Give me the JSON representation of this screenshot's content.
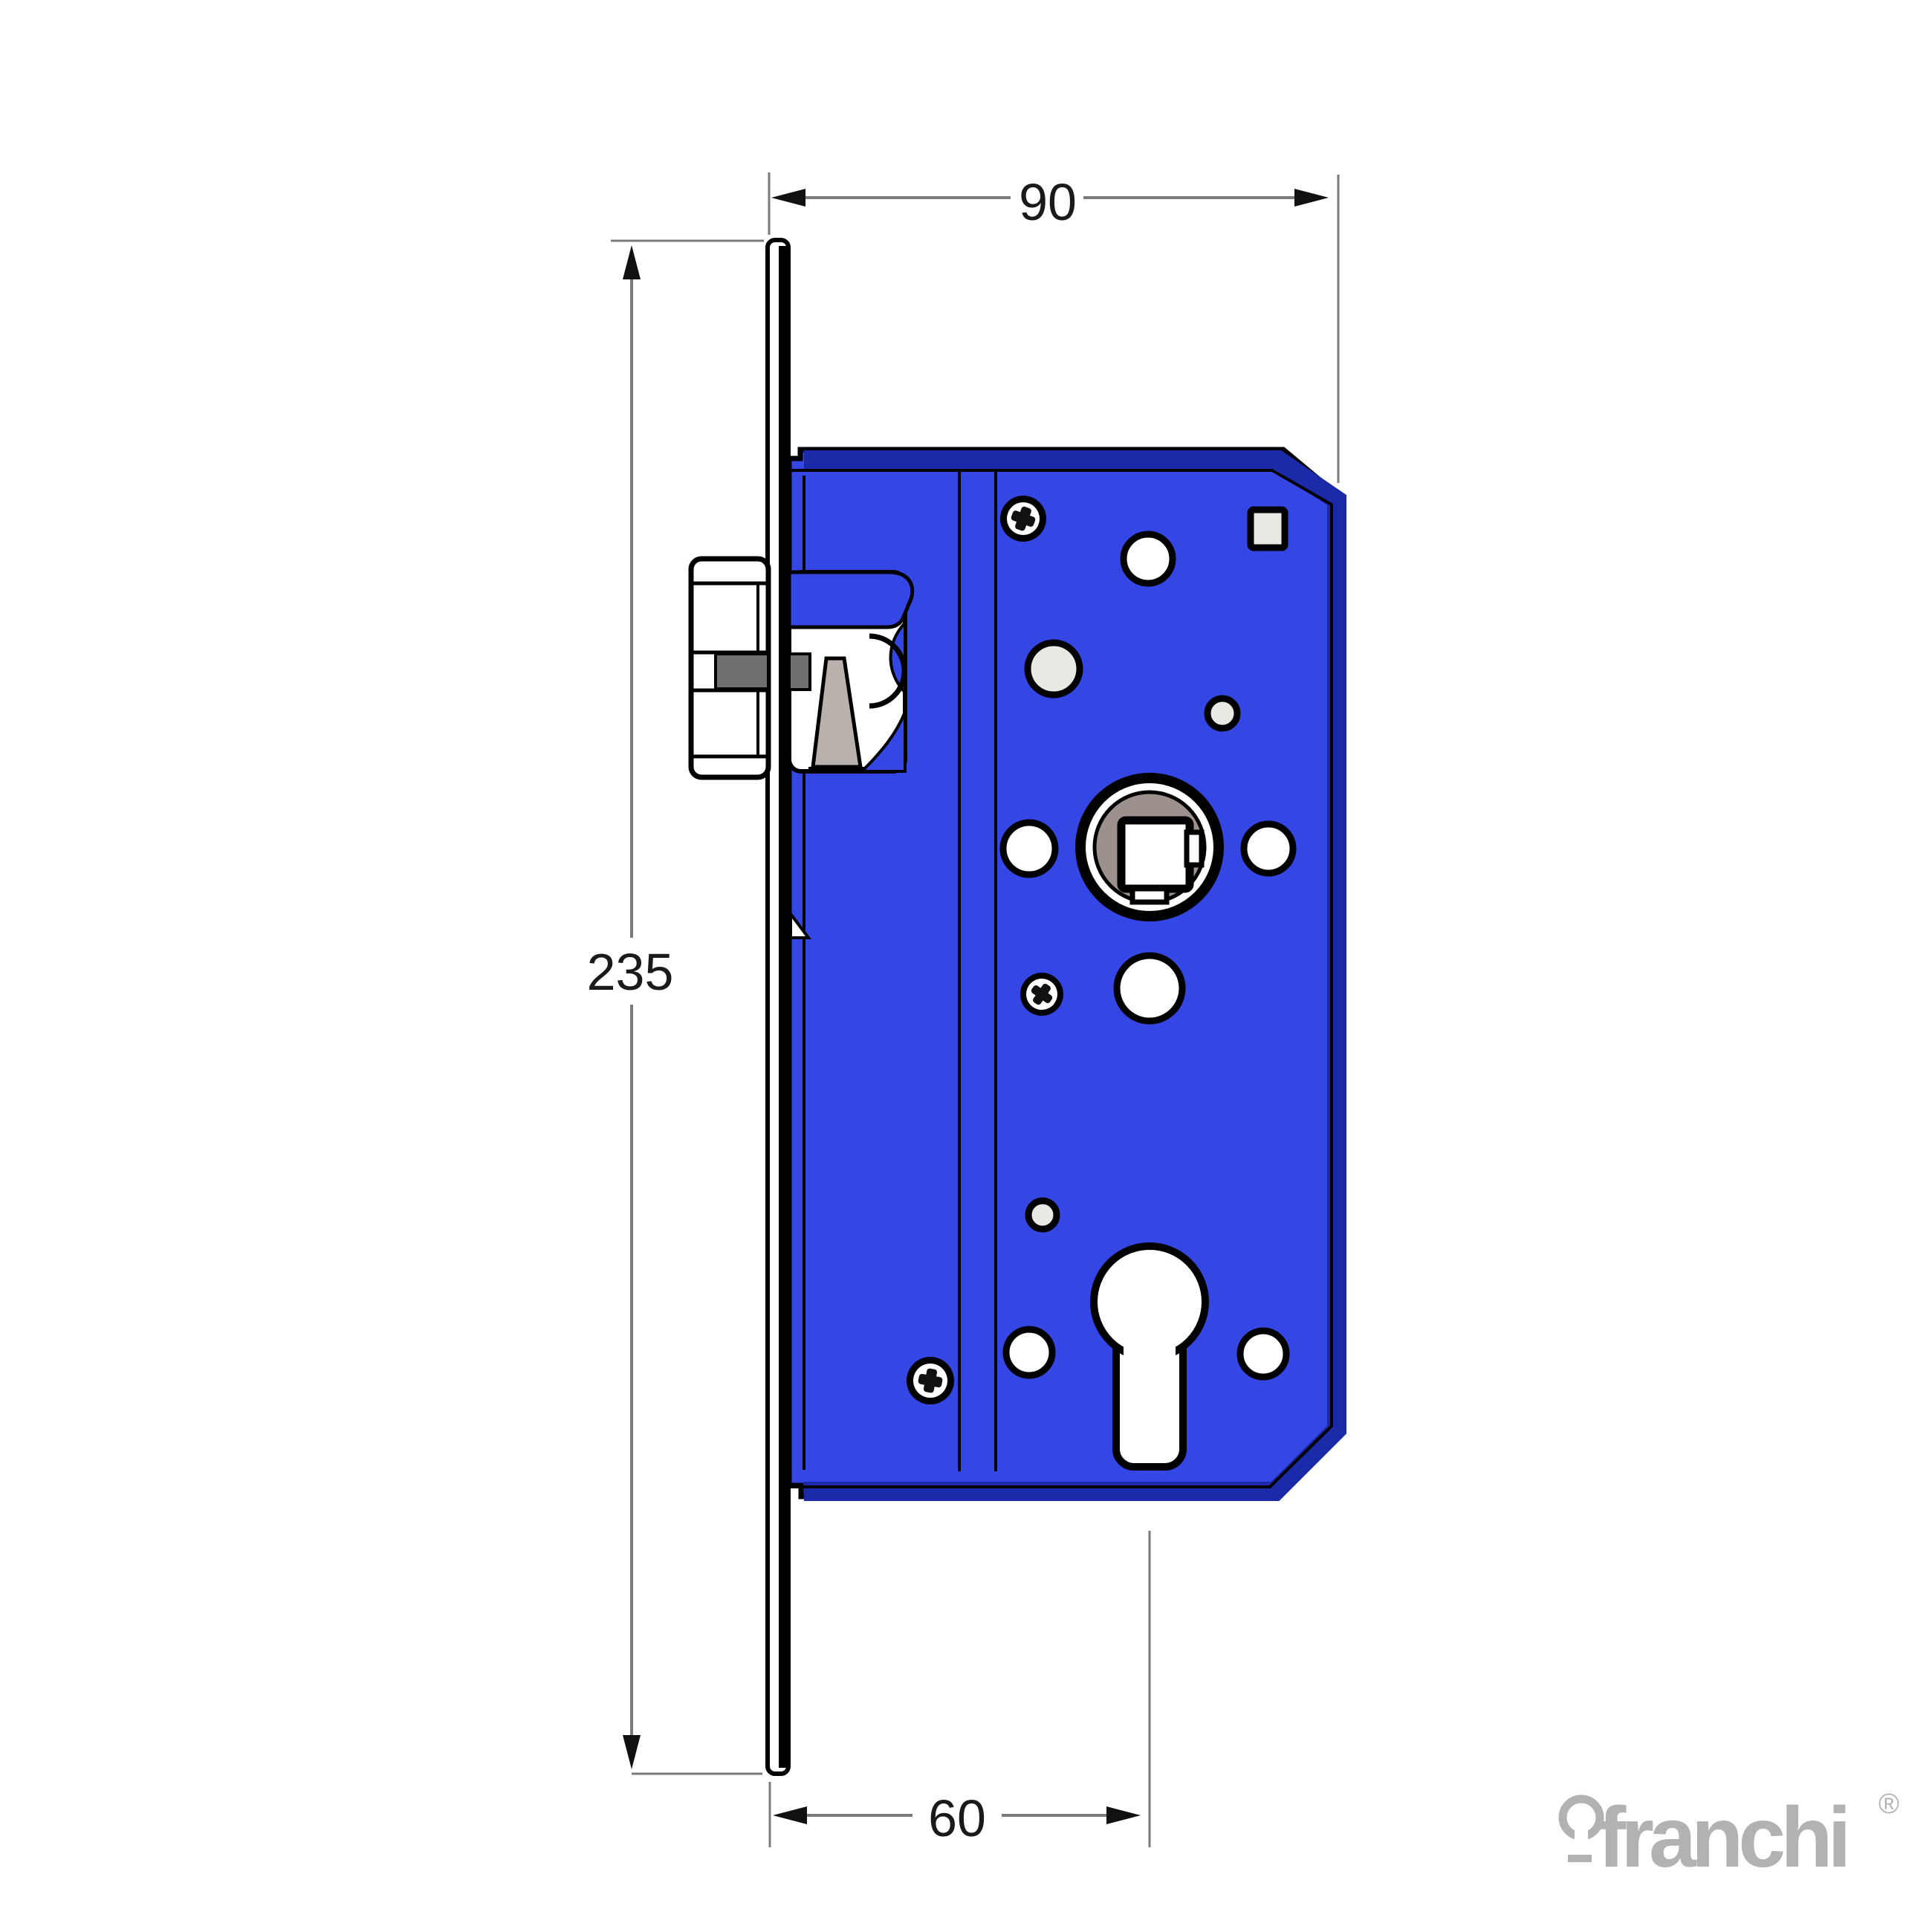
{
  "colors": {
    "body_blue": "#3447e4",
    "body_shadow": "#1a2aa8",
    "outline": "#000000",
    "dim_line": "#7b7b7b",
    "dim_arrow": "#111111",
    "dim_text": "#1a1a1a",
    "hole_white": "#ffffff",
    "hole_gray": "#e9e9e3",
    "metal_gray": "#6f6f6f",
    "hub_taupe": "#9c918d",
    "spring_gray": "#b9b2ac",
    "logo_gray": "#b2b2b2"
  },
  "dimensions": {
    "case_depth": {
      "label": "90"
    },
    "faceplate_height": {
      "label": "235"
    },
    "backset": {
      "label": "60"
    }
  },
  "brand": {
    "name": "franchi",
    "registered_mark": "®"
  }
}
